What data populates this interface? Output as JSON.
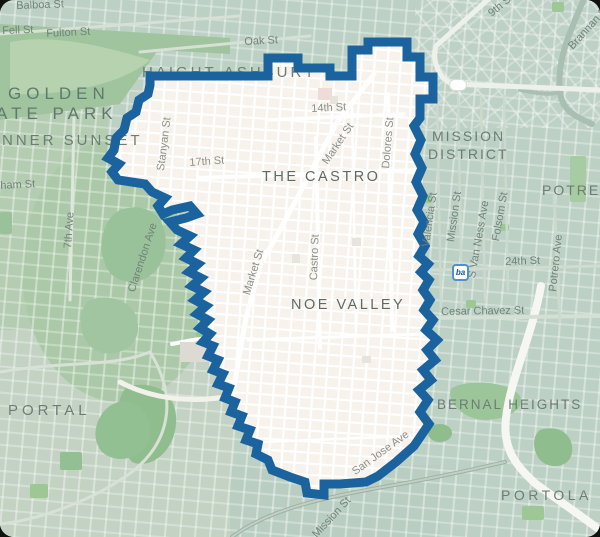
{
  "map": {
    "colors": {
      "base_teal": "#bcd0c4",
      "boundary_blue": "#1a639e",
      "interior_beige": "#f7f3ec",
      "park_green": "#a3cb97",
      "forest_green": "#9ac29a",
      "bart_border_blue": "#4e90d0"
    },
    "boundary_path": "M 150,76 L 268,76 L 268,58 L 298,58 L 298,68 L 330,68 L 330,76 L 352,76 L 352,50 L 368,50 L 368,42 L 407,42 L 407,57 L 420,57 L 420,77 L 433,77 L 433,99 L 420,99 L 420,118 L 414,126 L 421,140 L 415,154 L 422,168 L 416,182 L 423,196 L 417,210 L 424,222 L 418,234 L 425,246 L 419,256 L 428,264 L 421,272 L 429,280 L 423,290 L 430,300 L 424,310 L 433,320 L 426,330 L 437,340 L 427,350 L 435,360 L 423,370 L 431,380 L 419,390 L 428,400 L 420,412 L 429,424 L 414,446 L 396,462 L 378,476 L 366,482 L 340,484 L 324,484 L 324,495 L 307,493 L 305,482 L 290,477 L 272,470 L 268,460 L 256,454 L 258,444 L 246,440 L 250,430 L 238,426 L 242,416 L 231,412 L 235,402 L 225,398 L 229,388 L 218,384 L 223,374 L 213,370 L 218,360 L 208,356 L 213,346 L 203,342 L 210,334 L 200,328 L 208,320 L 197,314 L 206,306 L 195,300 L 204,292 L 192,286 L 201,278 L 189,272 L 198,264 L 186,258 L 194,250 L 181,244 L 190,236 L 177,230 L 170,222 L 186,218 L 197,214 L 190,206 L 172,210 L 163,214 L 158,206 L 165,198 L 152,192 L 145,184 L 118,180 L 112,172 L 119,164 L 108,158 L 114,150 L 116,138 L 124,130 L 127,118 L 136,112 L 139,100 L 148,94 L 150,85 Z",
    "tints": [
      {
        "type": "rect",
        "x": 0,
        "y": 98,
        "w": 108,
        "h": 252,
        "c": "#b4ccb2"
      },
      {
        "type": "rect",
        "x": 0,
        "y": 330,
        "w": 234,
        "h": 207,
        "c": "#c3d2c3"
      },
      {
        "type": "rect",
        "x": 415,
        "y": 0,
        "w": 185,
        "h": 128,
        "c": "#bed1c6"
      },
      {
        "type": "ellipse",
        "cx": 120,
        "cy": 270,
        "rx": 98,
        "ry": 132,
        "c": "#abc9a8"
      },
      {
        "type": "rect",
        "x": 230,
        "y": 465,
        "w": 210,
        "h": 72,
        "c": "#b9cec1"
      }
    ],
    "parks": [
      {
        "type": "path",
        "d": "M 0,24 L 230,38 L 230,54 L 158,50 L 120,104 L 0,120 Z",
        "c": "#a0c49e"
      },
      {
        "type": "path",
        "d": "M 10,42 C 60,32 122,52 150,60 C 120,86 60,96 10,94 Z",
        "c": "#b7d2af"
      },
      {
        "type": "path",
        "d": "M 128,386 C 160,380 178,396 176,424 C 174,452 150,470 132,462 C 116,444 112,398 128,386 Z",
        "c": "#8fbd8e"
      },
      {
        "type": "path",
        "d": "M 118,402 C 98,408 88,436 102,452 C 118,466 146,458 150,436 C 152,416 138,398 118,402 Z",
        "c": "#93c093"
      },
      {
        "type": "path",
        "d": "M 452,388 C 470,378 510,382 520,396 C 526,408 508,420 484,420 C 464,420 444,400 452,388 Z",
        "c": "#9cc59a"
      },
      {
        "type": "path",
        "d": "M 120,210 C 150,200 170,220 165,250 C 160,280 130,290 112,275 C 96,258 98,222 120,210 Z",
        "c": "#9ac29a"
      },
      {
        "type": "path",
        "d": "M 90,300 C 115,292 140,305 138,330 C 136,352 108,360 92,348 C 78,336 76,310 90,300 Z",
        "c": "#a0c5a0"
      },
      {
        "type": "path",
        "d": "M 246,84 C 262,78 286,84 288,96 C 290,106 272,112 256,110 C 242,108 238,92 246,84 Z",
        "c": "#9dc795"
      },
      {
        "type": "rect",
        "x": 552,
        "y": 2,
        "w": 12,
        "h": 10,
        "c": "#9dc795"
      },
      {
        "type": "rect",
        "x": 570,
        "y": 156,
        "w": 16,
        "h": 46,
        "c": "#a7cba2"
      },
      {
        "type": "rect",
        "x": 420,
        "y": 194,
        "w": 12,
        "h": 9,
        "c": "#9dc795"
      },
      {
        "type": "rect",
        "x": 466,
        "y": 300,
        "w": 10,
        "h": 8,
        "c": "#9dc795"
      },
      {
        "type": "rect",
        "x": 500,
        "y": 224,
        "w": 9,
        "h": 7,
        "c": "#9dc795"
      },
      {
        "type": "ellipse",
        "cx": 440,
        "cy": 433,
        "rx": 12,
        "ry": 9,
        "c": "#8fbd8e"
      },
      {
        "type": "path",
        "d": "M 540,430 C 558,424 574,434 572,452 C 570,468 550,470 540,460 C 532,450 532,436 540,430 Z",
        "c": "#8fbd8e"
      },
      {
        "type": "rect",
        "x": 522,
        "y": 506,
        "w": 22,
        "h": 14,
        "c": "#9dc795"
      },
      {
        "type": "rect",
        "x": 60,
        "y": 452,
        "w": 22,
        "h": 18,
        "c": "#93c093"
      },
      {
        "type": "rect",
        "x": 30,
        "y": 484,
        "w": 18,
        "h": 14,
        "c": "#9dc795"
      },
      {
        "type": "rect",
        "x": 0,
        "y": 212,
        "w": 12,
        "h": 22,
        "c": "#9ac29a"
      },
      {
        "type": "rect",
        "x": 250,
        "y": 152,
        "w": 26,
        "h": 26,
        "c": "#9dc795"
      },
      {
        "type": "rect",
        "x": 348,
        "y": 140,
        "w": 13,
        "h": 19,
        "c": "#a3cb97"
      },
      {
        "type": "rect",
        "x": 222,
        "y": 240,
        "w": 20,
        "h": 15,
        "c": "#a3cb97"
      },
      {
        "type": "rect",
        "x": 240,
        "y": 354,
        "w": 22,
        "h": 22,
        "c": "#98c492"
      },
      {
        "type": "rect",
        "x": 330,
        "y": 384,
        "w": 26,
        "h": 11,
        "c": "#a3cb97"
      },
      {
        "type": "rect",
        "x": 282,
        "y": 318,
        "w": 12,
        "h": 14,
        "c": "#a3cb97"
      },
      {
        "type": "rect",
        "x": 300,
        "y": 430,
        "w": 18,
        "h": 12,
        "c": "#a3cb97"
      },
      {
        "type": "rect",
        "x": 196,
        "y": 332,
        "w": 14,
        "h": 16,
        "c": "#98c492"
      }
    ],
    "roads_outside": [
      {
        "d": "M 586,-6 C 572,28 556,58 560,92 C 562,110 574,116 592,124",
        "s": "#a9bfb2",
        "w": 6
      },
      {
        "d": "M 560,92 C 548,96 532,92 520,90",
        "s": "#a9bfb2",
        "w": 4
      },
      {
        "d": "M 492,-4 L 436,46 C 432,60 438,78 452,84 L 600,90",
        "s": "#eef1ea",
        "w": 5
      },
      {
        "d": "M 0,34 L 240,16",
        "s": "#d6e0d4",
        "w": 3
      },
      {
        "d": "M 140,52 L 310,36",
        "s": "#d6e0d4",
        "w": 3
      },
      {
        "d": "M 74,118 L 70,300",
        "s": "#dfe7dd",
        "w": 3
      },
      {
        "d": "M 541,286 C 532,336 510,380 506,418 C 502,450 518,468 536,484 L 578,514 L 600,530",
        "s": "#f6f7f3",
        "w": 8
      },
      {
        "d": "M 232,537 C 270,508 330,496 400,484 C 440,477 470,470 505,462",
        "s": "#9db1a5",
        "w": 4
      },
      {
        "d": "M 232,537 C 270,508 330,496 400,484 C 440,477 470,470 505,462",
        "s": "#c2cfc2",
        "w": 2
      },
      {
        "d": "M 428,318 L 600,316",
        "s": "#d5e0d4",
        "w": 4
      },
      {
        "d": "M 430,270 L 600,266",
        "s": "#cfdccf",
        "w": 3
      },
      {
        "d": "M 437,96 L 441,312",
        "s": "#ccd9cd",
        "w": 2.5
      },
      {
        "d": "M 458,96 L 462,312",
        "s": "#ccd9cd",
        "w": 2.5
      },
      {
        "d": "M 481,96 L 485,300",
        "s": "#ccd9cd",
        "w": 2.5
      },
      {
        "d": "M 504,96 L 508,290",
        "s": "#ccd9cd",
        "w": 2.5
      },
      {
        "d": "M 554,196 L 560,322",
        "s": "#ccd9cd",
        "w": 3
      },
      {
        "d": "M 0,372 C 70,360 110,368 150,352",
        "s": "#d8e1d6",
        "w": 3
      },
      {
        "d": "M 150,352 C 180,400 170,450 120,480 C 90,500 40,520 0,524",
        "s": "#d8e1d6",
        "w": 3
      },
      {
        "d": "M 230,396 C 190,404 150,398 120,382",
        "s": "#f2f1ec",
        "w": 5
      },
      {
        "d": "M 172,344 C 210,336 250,332 292,330",
        "s": "#ffffff",
        "w": 4
      }
    ],
    "roads_inside": [
      {
        "d": "M 374,74 L 336,124 L 294,204 L 260,266 L 246,318 L 232,398",
        "w": 5
      },
      {
        "d": "M 388,94 L 392,330",
        "w": 4
      },
      {
        "d": "M 316,138 L 320,348",
        "w": 4
      },
      {
        "d": "M 352,108 L 356,330",
        "w": 2.5
      },
      {
        "d": "M 266,120 L 404,114",
        "w": 3.5
      },
      {
        "d": "M 198,178 L 420,170",
        "w": 4
      },
      {
        "d": "M 248,340 L 424,334",
        "w": 3
      },
      {
        "d": "M 262,442 L 410,436",
        "w": 2.5
      }
    ],
    "buildings": [
      {
        "x": 318,
        "y": 88,
        "w": 14,
        "h": 12,
        "c": "#efdbd7"
      },
      {
        "x": 180,
        "y": 342,
        "w": 30,
        "h": 20,
        "c": "#dddad3"
      },
      {
        "x": 352,
        "y": 238,
        "w": 9,
        "h": 8,
        "c": "#e7e4dd"
      },
      {
        "x": 292,
        "y": 254,
        "w": 8,
        "h": 9,
        "c": "#e7e4dd"
      },
      {
        "x": 362,
        "y": 356,
        "w": 9,
        "h": 7,
        "c": "#e7e4dd"
      },
      {
        "x": 330,
        "y": 96,
        "w": 8,
        "h": 8,
        "c": "#e7e4dd"
      }
    ],
    "labels": [
      {
        "name": "label-haight-ashbury",
        "text": "HAIGHT-ASHBURY",
        "x": 142,
        "y": 64,
        "rot": 0,
        "cls": "nhood-teal",
        "layer": "under",
        "fs": 15,
        "ls": 3
      },
      {
        "name": "label-inner-sunset",
        "text": "NNER SUNSET",
        "x": 2,
        "y": 132,
        "rot": 0,
        "cls": "nhood-teal",
        "layer": "under",
        "fs": 15,
        "ls": 3
      },
      {
        "name": "label-golden-gate-park-line1",
        "text": "GOLDEN",
        "x": 8,
        "y": 84,
        "rot": 0,
        "cls": "nhood-park",
        "layer": "under"
      },
      {
        "name": "label-golden-gate-park-line2",
        "text": "ATE PARK",
        "x": -4,
        "y": 104,
        "rot": 0,
        "cls": "nhood-park",
        "layer": "under"
      },
      {
        "name": "label-stanyan-st",
        "text": "Stanyan St",
        "x": 155,
        "y": 170,
        "rot": -83,
        "cls": "street-beige",
        "layer": "under"
      },
      {
        "name": "label-clarendon-ave",
        "text": "Clarendon Ave",
        "x": 126,
        "y": 290,
        "rot": -72,
        "cls": "street-teal",
        "layer": "under"
      },
      {
        "name": "label-san-jose-ave",
        "text": "San Jose Ave",
        "x": 350,
        "y": 468,
        "rot": -36,
        "cls": "street-beige",
        "layer": "under"
      },
      {
        "name": "label-market-st-lower",
        "text": "Market St",
        "x": 241,
        "y": 293,
        "rot": -73,
        "cls": "street-beige",
        "layer": "under"
      },
      {
        "name": "label-balboa-st",
        "text": "Balboa St",
        "x": 16,
        "y": 0,
        "rot": -2,
        "cls": "street-teal",
        "layer": "over"
      },
      {
        "name": "label-fulton-st",
        "text": "Fulton St",
        "x": 46,
        "y": 28,
        "rot": -3,
        "cls": "street-teal",
        "layer": "over"
      },
      {
        "name": "label-fell-st",
        "text": "Fell St",
        "x": 2,
        "y": 25,
        "rot": -2,
        "cls": "street-teal",
        "layer": "over"
      },
      {
        "name": "label-oak-st",
        "text": "Oak St",
        "x": 244,
        "y": 36,
        "rot": -3,
        "cls": "street-teal",
        "layer": "over"
      },
      {
        "name": "label-8th-st",
        "text": "8th St",
        "x": 510,
        "y": -6,
        "rot": -40,
        "cls": "street-teal",
        "layer": "over"
      },
      {
        "name": "label-9th-st",
        "text": "9th St",
        "x": 486,
        "y": 10,
        "rot": -40,
        "cls": "street-teal",
        "layer": "over"
      },
      {
        "name": "label-brannan-st",
        "text": "Brannan St",
        "x": 566,
        "y": 44,
        "rot": -48,
        "cls": "street-teal",
        "layer": "over"
      },
      {
        "name": "label-folsom-st-top",
        "text": "Folsom St",
        "x": 524,
        "y": -10,
        "rot": -72,
        "cls": "street-teal",
        "layer": "over"
      },
      {
        "name": "label-mission-district-line1",
        "text": "MISSION",
        "x": 432,
        "y": 128,
        "rot": 0,
        "cls": "nhood-teal",
        "layer": "over"
      },
      {
        "name": "label-mission-district-line2",
        "text": "DISTRICT",
        "x": 428,
        "y": 146,
        "rot": 0,
        "cls": "nhood-teal",
        "layer": "over"
      },
      {
        "name": "label-the-castro",
        "text": "THE CASTRO",
        "x": 262,
        "y": 169,
        "rot": 0,
        "cls": "nhood-beige",
        "layer": "over"
      },
      {
        "name": "label-noe-valley",
        "text": "NOE VALLEY",
        "x": 291,
        "y": 297,
        "rot": 0,
        "cls": "nhood-beige",
        "layer": "over"
      },
      {
        "name": "label-portal",
        "text": "PORTAL",
        "x": 8,
        "y": 402,
        "rot": 0,
        "cls": "nhood-teal",
        "layer": "over",
        "fs": 15,
        "ls": 4
      },
      {
        "name": "label-bernal-heights",
        "text": "BERNAL HEIGHTS",
        "x": 437,
        "y": 397,
        "rot": 0,
        "cls": "nhood-teal",
        "layer": "over",
        "fs": 13.5
      },
      {
        "name": "label-portola",
        "text": "PORTOLA",
        "x": 501,
        "y": 487,
        "rot": 0,
        "cls": "nhood-teal",
        "layer": "over",
        "fs": 14,
        "ls": 3.5
      },
      {
        "name": "label-potrero",
        "text": "POTRERO",
        "x": 542,
        "y": 182,
        "rot": 0,
        "cls": "nhood-teal",
        "layer": "over"
      },
      {
        "name": "label-7th-ave",
        "text": "7th Ave",
        "x": 62,
        "y": 248,
        "rot": -86,
        "cls": "street-teal",
        "layer": "over"
      },
      {
        "name": "label-kirkham-st",
        "text": "ham St",
        "x": 0,
        "y": 180,
        "rot": -3,
        "cls": "street-teal",
        "layer": "over"
      },
      {
        "name": "label-17th-st",
        "text": "17th St",
        "x": 189,
        "y": 157,
        "rot": -4,
        "cls": "street-beige",
        "layer": "over"
      },
      {
        "name": "label-14th-st",
        "text": "14th St",
        "x": 311,
        "y": 103,
        "rot": -3,
        "cls": "street-beige",
        "layer": "over"
      },
      {
        "name": "label-market-st-upper",
        "text": "Market St",
        "x": 320,
        "y": 160,
        "rot": -56,
        "cls": "street-beige",
        "layer": "over"
      },
      {
        "name": "label-dolores-st",
        "text": "Dolores St",
        "x": 380,
        "y": 168,
        "rot": -85,
        "cls": "street-beige",
        "layer": "over"
      },
      {
        "name": "label-castro-st",
        "text": "Castro St",
        "x": 308,
        "y": 280,
        "rot": -88,
        "cls": "street-beige",
        "layer": "over"
      },
      {
        "name": "label-valencia-st",
        "text": "Valencia St",
        "x": 420,
        "y": 246,
        "rot": -82,
        "cls": "street-teal",
        "layer": "over"
      },
      {
        "name": "label-mission-st",
        "text": "Mission St",
        "x": 445,
        "y": 241,
        "rot": -82,
        "cls": "street-teal",
        "layer": "over"
      },
      {
        "name": "label-s-van-ness-ave",
        "text": "S Van Ness Ave",
        "x": 466,
        "y": 277,
        "rot": -80,
        "cls": "street-teal",
        "layer": "over"
      },
      {
        "name": "label-folsom-st",
        "text": "Folsom St",
        "x": 490,
        "y": 240,
        "rot": -80,
        "cls": "street-teal",
        "layer": "over"
      },
      {
        "name": "label-24th-st",
        "text": "24th St",
        "x": 505,
        "y": 256,
        "rot": -2,
        "cls": "street-teal",
        "layer": "over"
      },
      {
        "name": "label-potrero-ave",
        "text": "Potrero Ave",
        "x": 547,
        "y": 291,
        "rot": -84,
        "cls": "street-teal",
        "layer": "over"
      },
      {
        "name": "label-cesar-chavez-st",
        "text": "Cesar Chavez St",
        "x": 441,
        "y": 306,
        "rot": -1,
        "cls": "street-teal",
        "layer": "over"
      },
      {
        "name": "label-mission-st-south",
        "text": "Mission St",
        "x": 310,
        "y": 532,
        "rot": -47,
        "cls": "street-teal",
        "layer": "over"
      }
    ],
    "bart_icon": {
      "x": 452,
      "y": 264,
      "glyph": "ba"
    },
    "road_badge": {
      "x": 450,
      "y": 80
    }
  }
}
